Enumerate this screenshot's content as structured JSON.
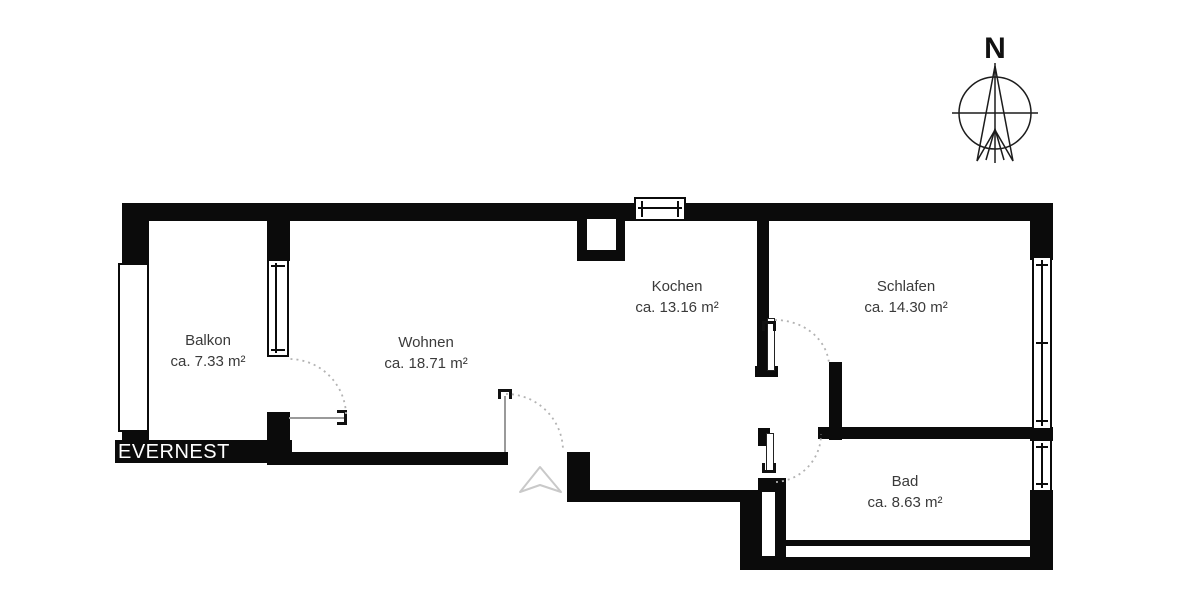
{
  "brand": {
    "name": "EVERNEST"
  },
  "compass": {
    "label": "N"
  },
  "rooms": [
    {
      "name": "Balkon",
      "area": "ca. 7.33 m²"
    },
    {
      "name": "Wohnen",
      "area": "ca. 18.71 m²"
    },
    {
      "name": "Kochen",
      "area": "ca. 13.16 m²"
    },
    {
      "name": "Schlafen",
      "area": "ca. 14.30 m²"
    },
    {
      "name": "Bad",
      "area": "ca. 8.63 m²"
    }
  ],
  "colors": {
    "wall": "#0b0b0b",
    "label_text": "#3a3a3a",
    "door_arc": "#b3b3b3",
    "entrance_marker": "#c9c9c9",
    "brand_bg": "#0b0b0b",
    "brand_text": "#ffffff"
  }
}
